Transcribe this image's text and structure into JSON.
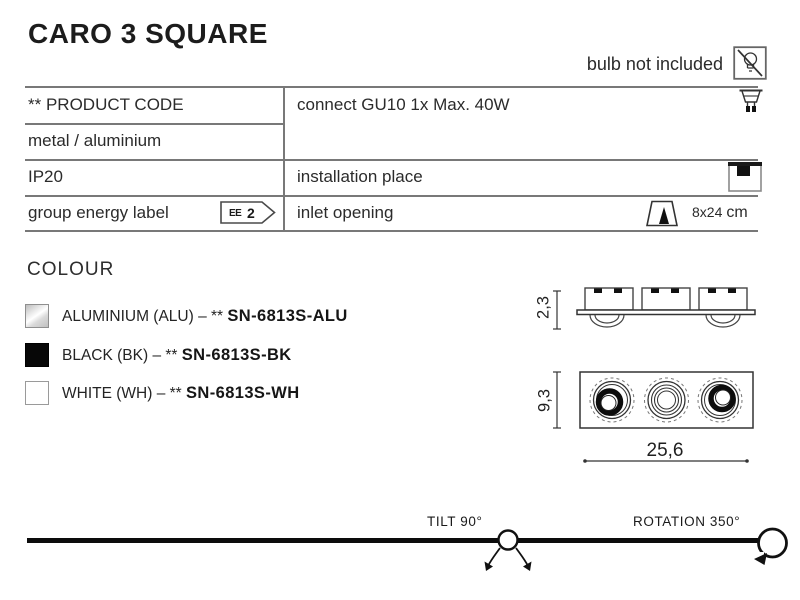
{
  "title": "CARO 3 SQUARE",
  "bulb_note": "bulb not included",
  "spec_table": {
    "product_code_label": "** PRODUCT CODE",
    "connection": "connect GU10 1x Max. 40W",
    "material": "metal / aluminium",
    "ip_rating": "IP20",
    "installation_label": "installation place",
    "energy_label": "group energy label",
    "energy_badge": {
      "prefix": "EE",
      "value": "2"
    },
    "inlet_label": "inlet opening",
    "inlet_size": "8x24",
    "inlet_unit": "cm"
  },
  "colour": {
    "heading": "COLOUR",
    "items": [
      {
        "prefix": "ALUMINIUM (ALU) – ** ",
        "code": "SN-6813S-ALU",
        "swatch_color": "#d8d8d8"
      },
      {
        "prefix": "BLACK (BK) – ** ",
        "code": "SN-6813S-BK",
        "swatch_color": "#070707"
      },
      {
        "prefix": "WHITE (WH) – ** ",
        "code": "SN-6813S-WH",
        "swatch_color": "#ffffff"
      }
    ]
  },
  "drawing": {
    "side_height_cm": "2,3",
    "front_height_cm": "9,3",
    "width_cm": "25,6"
  },
  "footer": {
    "tilt": "TILT 90°",
    "rotation": "ROTATION 350°"
  },
  "colors": {
    "text": "#232323",
    "table_line": "#787878",
    "drawing_line": "#333333",
    "black": "#0c0c0c"
  }
}
